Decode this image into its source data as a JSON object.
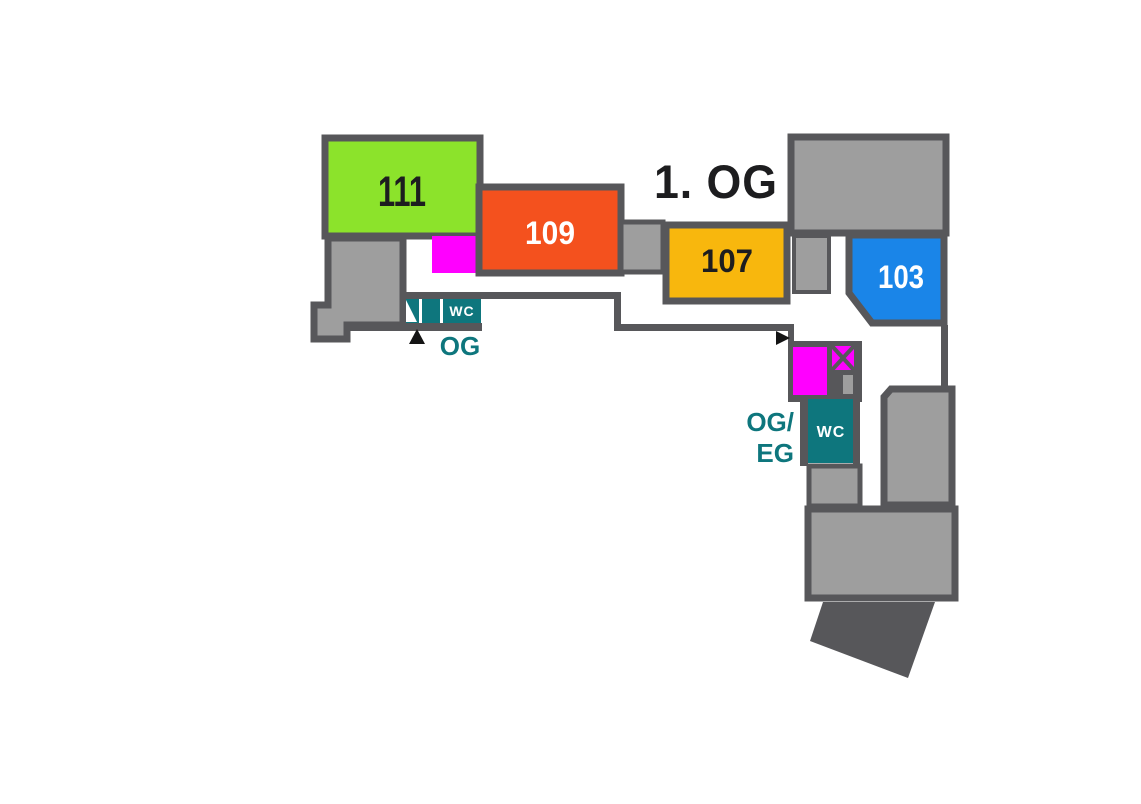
{
  "floor_plan": {
    "title": "1. OG",
    "rooms": [
      {
        "label": "111",
        "color": "#8ce32b"
      },
      {
        "label": "109",
        "color": "#f4511e"
      },
      {
        "label": "107",
        "color": "#f8b70d"
      },
      {
        "label": "103",
        "color": "#1a85e8"
      }
    ],
    "facilities": {
      "wc_left": "WC",
      "wc_right": "WC"
    },
    "stairs": {
      "left_label": "OG",
      "right_label_line1": "OG/",
      "right_label_line2": "EG"
    },
    "icons": {
      "elevator": "crossed-box",
      "entrance_left": "triangle-up",
      "entrance_right": "triangle-right"
    },
    "colors": {
      "wall": "#57575a",
      "structure_gray": "#9e9e9e",
      "stair_magenta": "#ff00ff",
      "wc_teal": "#0e767d",
      "label_teal": "#0e767d",
      "text_dark": "#1d1d1f",
      "text_white": "#ffffff",
      "background": "#ffffff"
    }
  }
}
